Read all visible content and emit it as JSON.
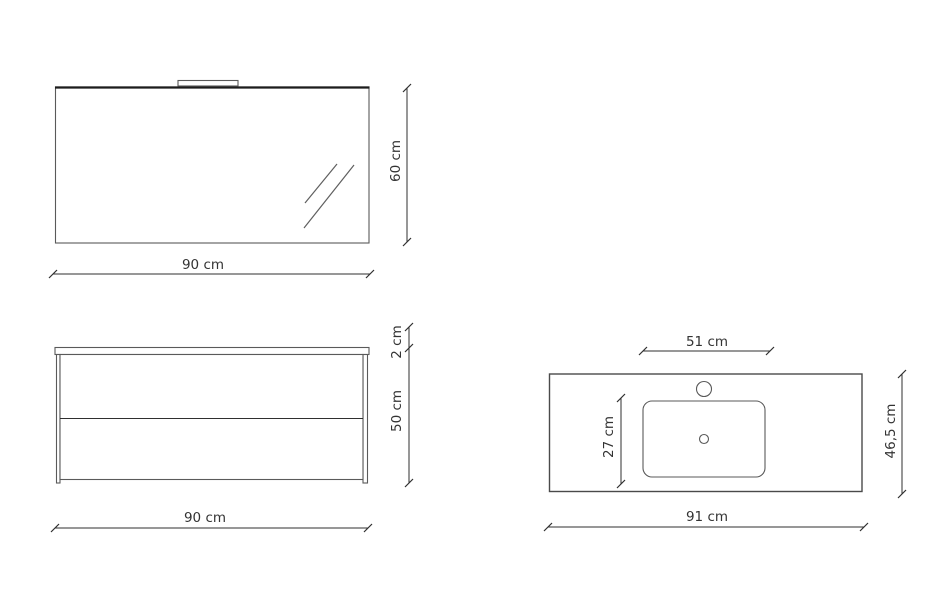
{
  "diagram": {
    "background_color": "#ffffff",
    "line_color": "#4a4a4a",
    "dimension_line_color": "#2f2f2f",
    "text_color": "#333333",
    "units": "cm",
    "mirror": {
      "view": "mirror-front-view-with-light",
      "width_label": "90 cm",
      "height_label": "60 cm"
    },
    "cabinet": {
      "view": "cabinet-front-view-two-drawers",
      "width_label": "90 cm",
      "height_label": "50 cm",
      "top_panel_thickness_label": "2 cm"
    },
    "washbasin": {
      "view": "countertop-top-view-with-basin",
      "width_label": "91 cm",
      "depth_label": "46,5 cm",
      "basin_width_label": "51 cm",
      "basin_depth_label": "27 cm"
    }
  }
}
